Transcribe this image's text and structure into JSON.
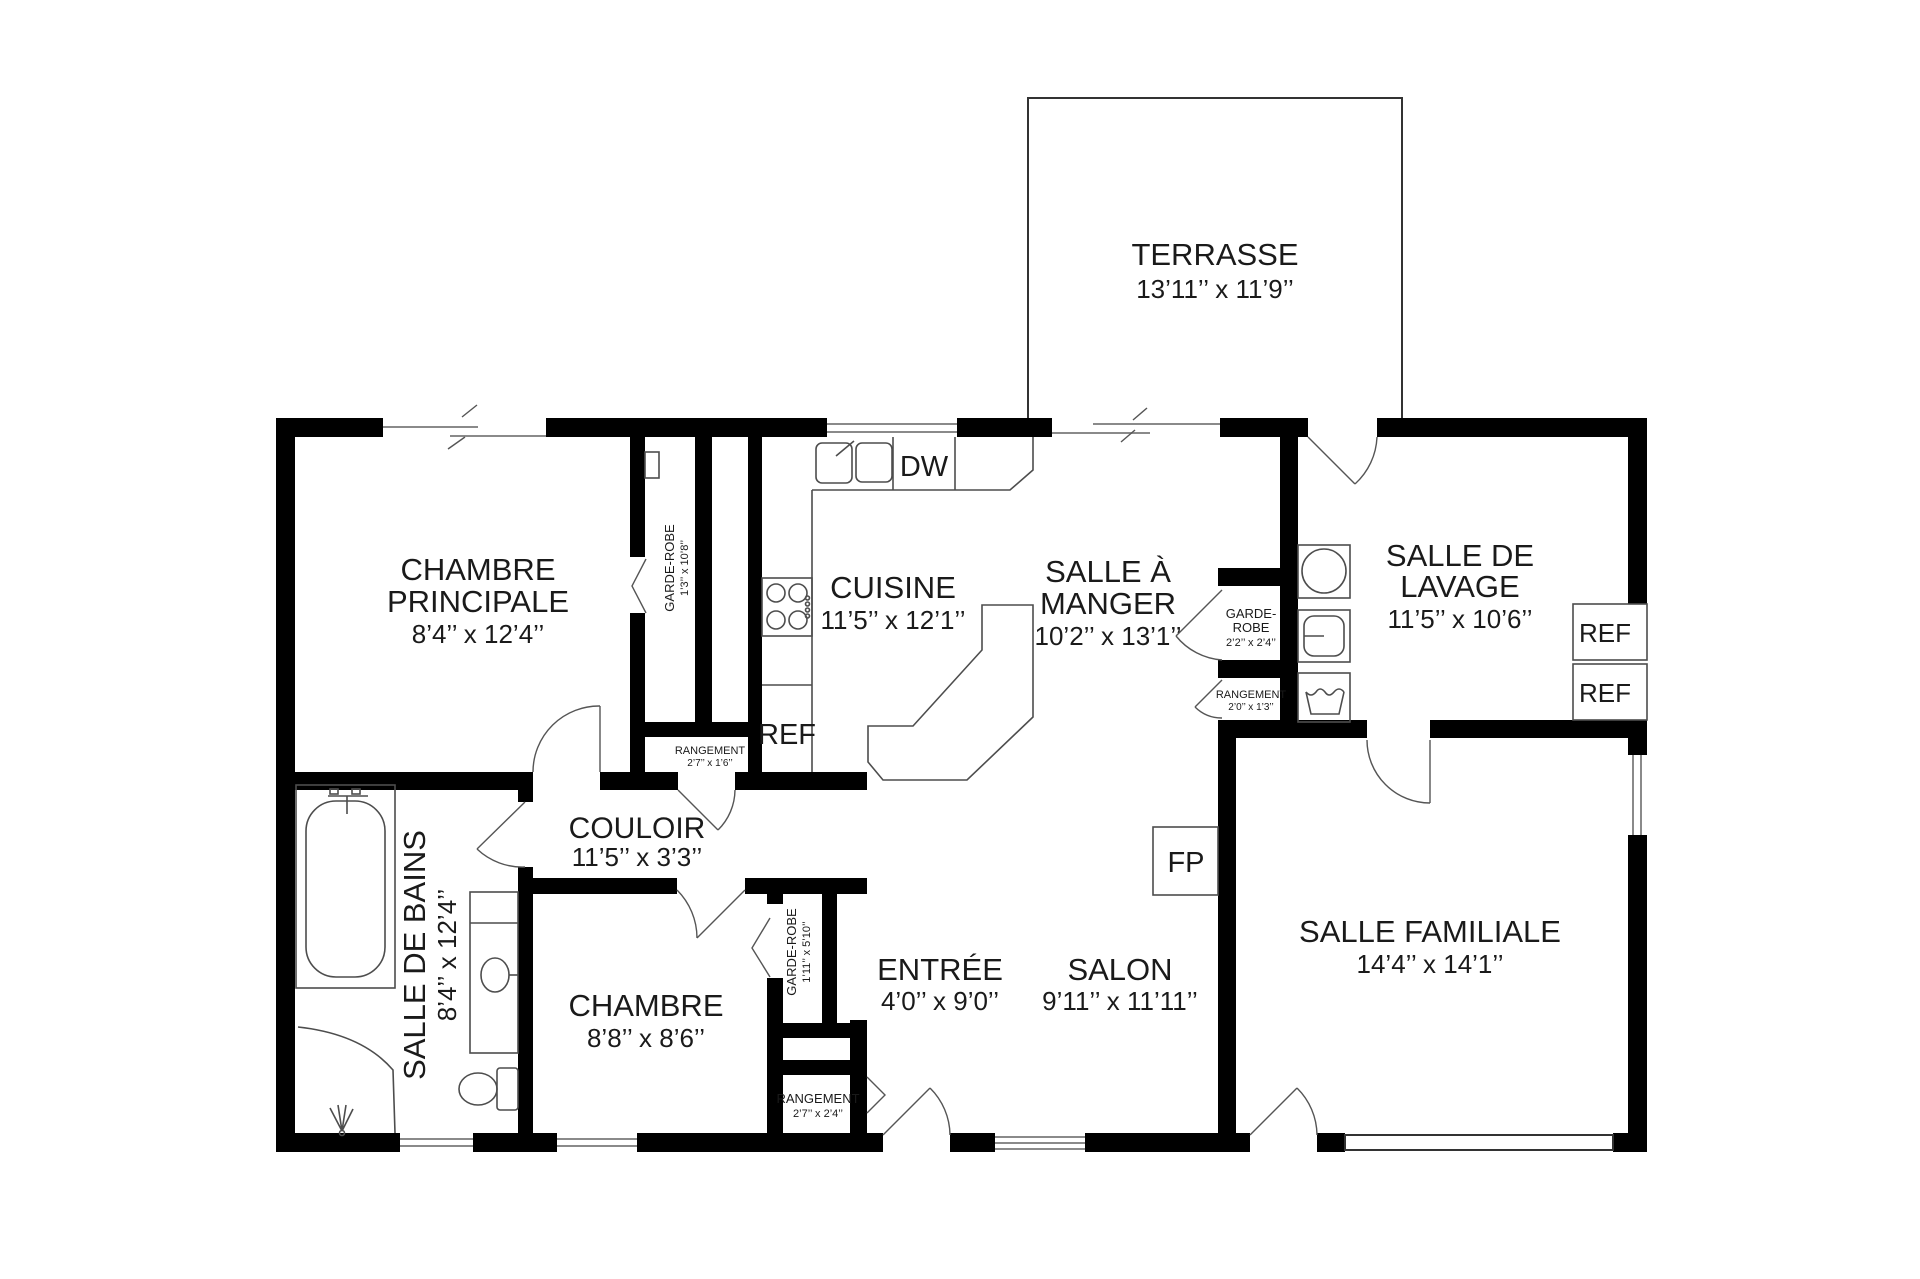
{
  "plan_type": "floor-plan",
  "rooms": {
    "terrasse": {
      "name": "TERRASSE",
      "dims": "13’11’’ x 11’9’’"
    },
    "chambre_principale": {
      "name1": "CHAMBRE",
      "name2": "PRINCIPALE",
      "dims": "8’4’’ x 12’4’’"
    },
    "cuisine": {
      "name": "CUISINE",
      "dims": "11’5’’ x 12’1’’"
    },
    "salle_a_manger": {
      "name1": "SALLE À",
      "name2": "MANGER",
      "dims": "10’2’’ x 13’1’’"
    },
    "salle_de_lavage": {
      "name1": "SALLE DE",
      "name2": "LAVAGE",
      "dims": "11’5’’ x 10’6’’"
    },
    "salle_de_bains": {
      "name": "SALLE DE BAINS",
      "dims": "8’4’’ x 12’4’’"
    },
    "couloir": {
      "name": "COULOIR",
      "dims": "11’5’’ x 3’3’’"
    },
    "chambre": {
      "name": "CHAMBRE",
      "dims": "8’8’’ x 8’6’’"
    },
    "entree": {
      "name": "ENTRÉE",
      "dims": "4’0’’ x 9’0’’"
    },
    "salon": {
      "name": "SALON",
      "dims": "9’11’’ x 11’11’’"
    },
    "salle_familiale": {
      "name": "SALLE FAMILIALE",
      "dims": "14’4’’ x 14’1’’"
    }
  },
  "closets": {
    "garde_robe_cuisine": {
      "name": "GARDE-ROBE",
      "dims": "1’3’’ x 10’8’’"
    },
    "garde_robe_chambre": {
      "name": "GARDE-ROBE",
      "dims": "1’11’’ x 5’10’’"
    },
    "garde_robe_salle_a_manger": {
      "name1": "GARDE-",
      "name2": "ROBE",
      "dims": "2’2’’ x 2’4’’"
    },
    "rangement_salle_a_manger": {
      "name": "RANGEMENT",
      "dims": "2’0’’ x 1’3’’"
    },
    "rangement_couloir": {
      "name": "RANGEMENT",
      "dims": "2’7’’ x 1’6’’"
    },
    "rangement_entree": {
      "name": "RANGEMENT",
      "dims": "2’7’’ x 2’4’’"
    }
  },
  "appliances": {
    "dishwasher": "DW",
    "refrigerator_cuisine": "REF",
    "refrigerator_1": "REF",
    "refrigerator_2": "REF",
    "fireplace": "FP"
  },
  "colors": {
    "wall": "#000000",
    "fixture_line": "#4d4d4d",
    "window_line": "#8a8a8a",
    "text": "#1a1a1a",
    "background": "#ffffff"
  }
}
